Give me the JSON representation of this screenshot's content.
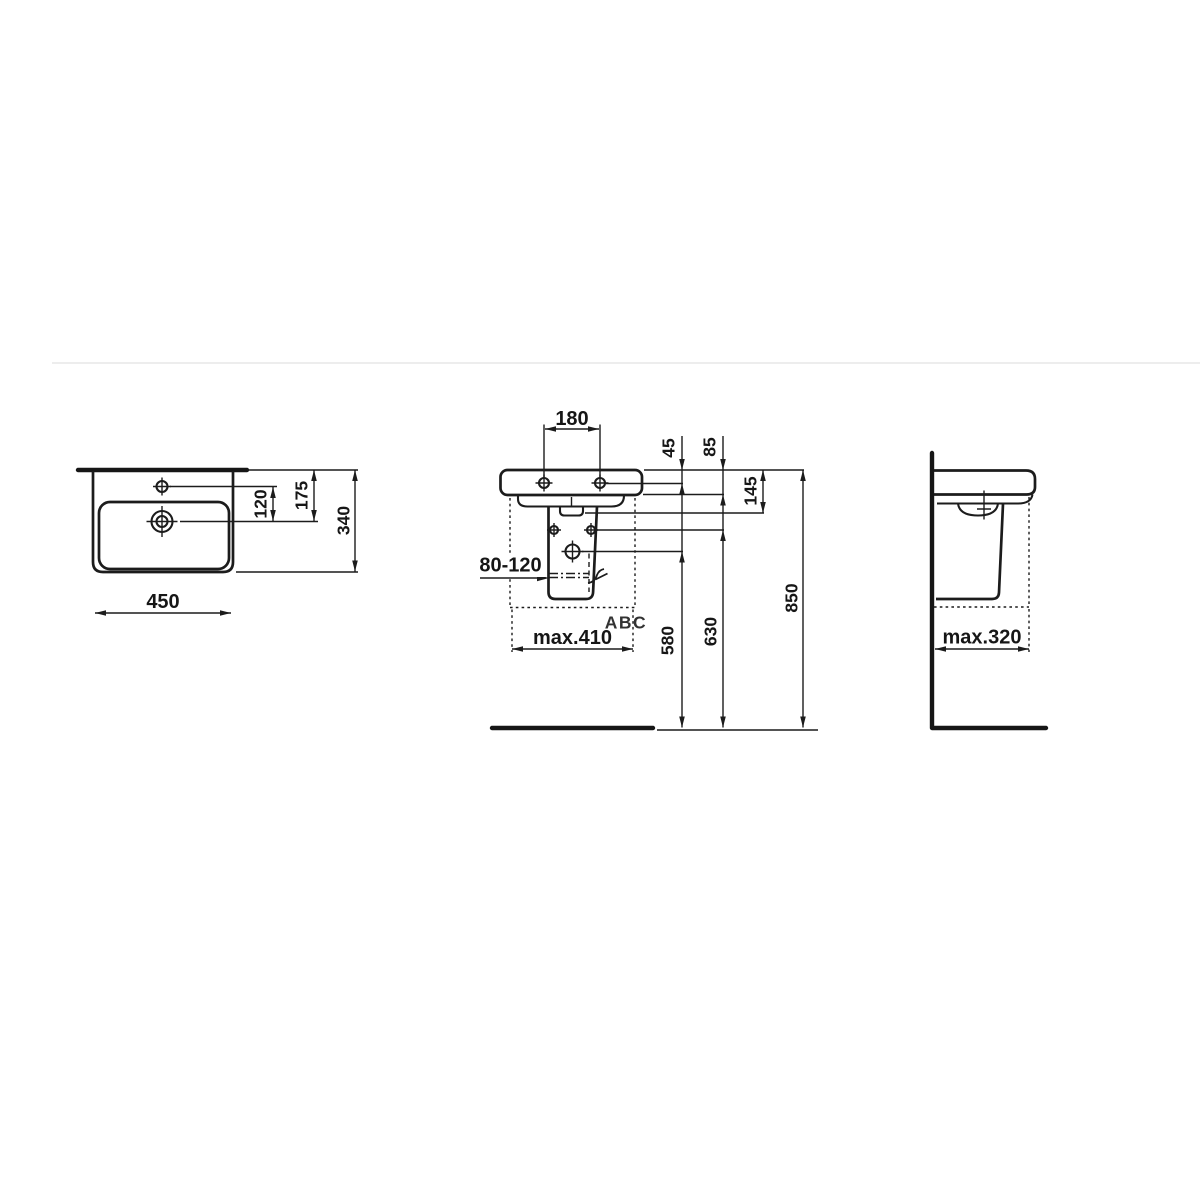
{
  "drawing": {
    "ink_color": "#1c1c1c",
    "divider_color": "#ededed",
    "watermark": {
      "text": "ABC",
      "color": "#9aca3c"
    },
    "top_view": {
      "labels": {
        "width": "450",
        "depth": "340",
        "tap_to_drain": "120",
        "edge_to_drain": "175"
      }
    },
    "front_view": {
      "labels": {
        "tap_hole_spacing": "180",
        "edge_to_tap_hole": "45",
        "rim_depth": "85",
        "edge_to_overflow": "145",
        "trap_range": "80-120",
        "max_width": "max.410",
        "drain_height": "580",
        "fixing_height": "630",
        "rim_height": "850"
      }
    },
    "side_view": {
      "labels": {
        "max_depth": "max.320"
      }
    }
  }
}
